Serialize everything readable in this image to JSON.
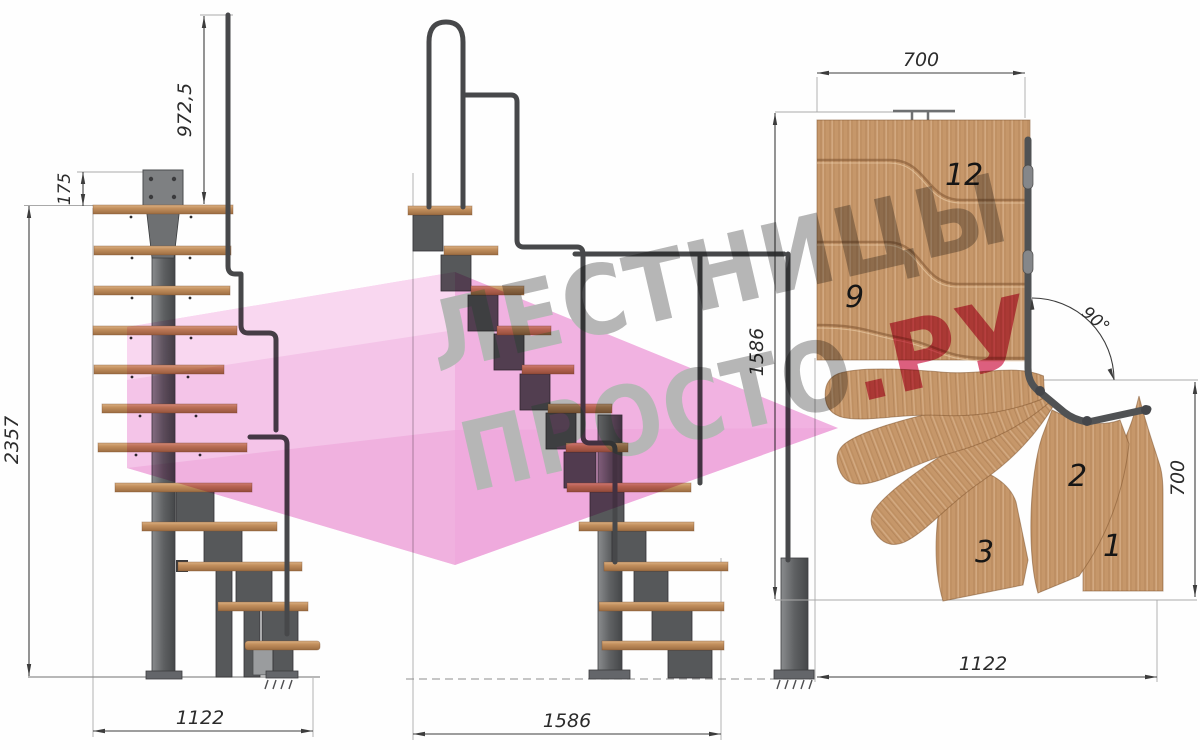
{
  "drawing": {
    "watermark": {
      "line1": "ЛЕСТНИЦЫ",
      "line2_gray": "ПРОСТО",
      "line2_red": ".РУ",
      "pink_color": "#f5c5e9",
      "red_color": "#dd5f7e",
      "gray_color": "#b7b7b7"
    },
    "left_view": {
      "dim_handrail_height": "972,5",
      "dim_plate_offset": "175",
      "dim_total_height": "2357",
      "dim_total_run": "1122"
    },
    "front_view": {
      "dim_total_run": "1586"
    },
    "plan_view": {
      "dim_top_width": "700",
      "dim_left_length": "1586",
      "dim_right_width": "700",
      "dim_bottom_length": "1122",
      "dim_turn_angle": "90°",
      "step_numbers": [
        "12",
        "9",
        "3",
        "2",
        "1"
      ]
    }
  }
}
